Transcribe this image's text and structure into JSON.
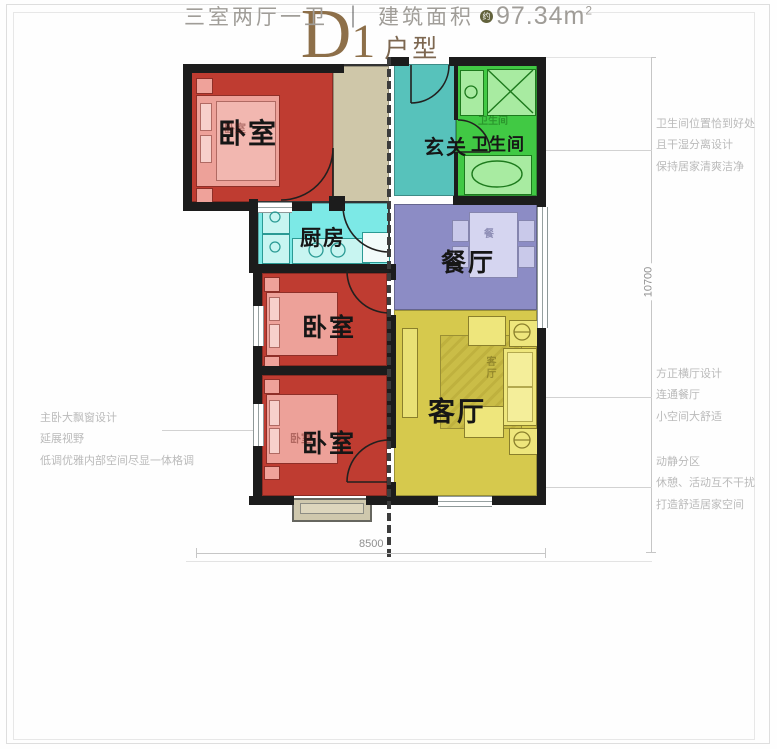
{
  "rooms": {
    "bedroom1": {
      "label": "卧室",
      "color": "#bf3c31"
    },
    "entry": {
      "label": "玄关",
      "color": "#57c2bb"
    },
    "bathroom": {
      "label": "卫生间",
      "color": "#41c944"
    },
    "kitchen": {
      "label": "厨房",
      "color": "#7ce9e6"
    },
    "dining": {
      "label": "餐厅",
      "color": "#8c8cc5"
    },
    "bedroom2": {
      "label": "卧室",
      "color": "#bf3c31"
    },
    "bedroom3": {
      "label": "卧室",
      "color": "#bf3c31"
    },
    "living": {
      "label": "客厅",
      "color": "#d6c94d"
    }
  },
  "marks": {
    "dining_table": "餐",
    "living_rug": "客厅",
    "bathroom_wm": "卫生间",
    "bed1_wm": "卧室",
    "bed3_wm": "卧室"
  },
  "dimensions": {
    "width": "8500",
    "height": "10700"
  },
  "annotations": {
    "bathroom": {
      "line1": "卫生间位置恰到好处",
      "line2": "且干湿分离设计",
      "line3": "保持居家清爽洁净"
    },
    "living": {
      "line1": "方正横厅设计",
      "line2": "连通餐厅",
      "line3": "小空间大舒适"
    },
    "zoning": {
      "line1": "动静分区",
      "line2": "休憩、活动互不干扰",
      "line3": "打造舒适居家空间"
    },
    "bedroom": {
      "line1": "主卧大飘窗设计",
      "line2": "延展视野",
      "line3": "低调优雅内部空间尽显一体格调"
    }
  },
  "title": {
    "letter": "D",
    "number": "1",
    "suffix": "户型"
  },
  "spec": {
    "rooms": "三室两厅一卫",
    "divider": "｜",
    "area_label": "建筑面积",
    "approx_badge": "约",
    "value": "97.34",
    "unit": "m",
    "unit_sup": "2"
  },
  "colors": {
    "wall": "#1c1c1c",
    "title": "#8d6f49",
    "annotation": "#bababa",
    "corridor": "#cfc7a9"
  }
}
